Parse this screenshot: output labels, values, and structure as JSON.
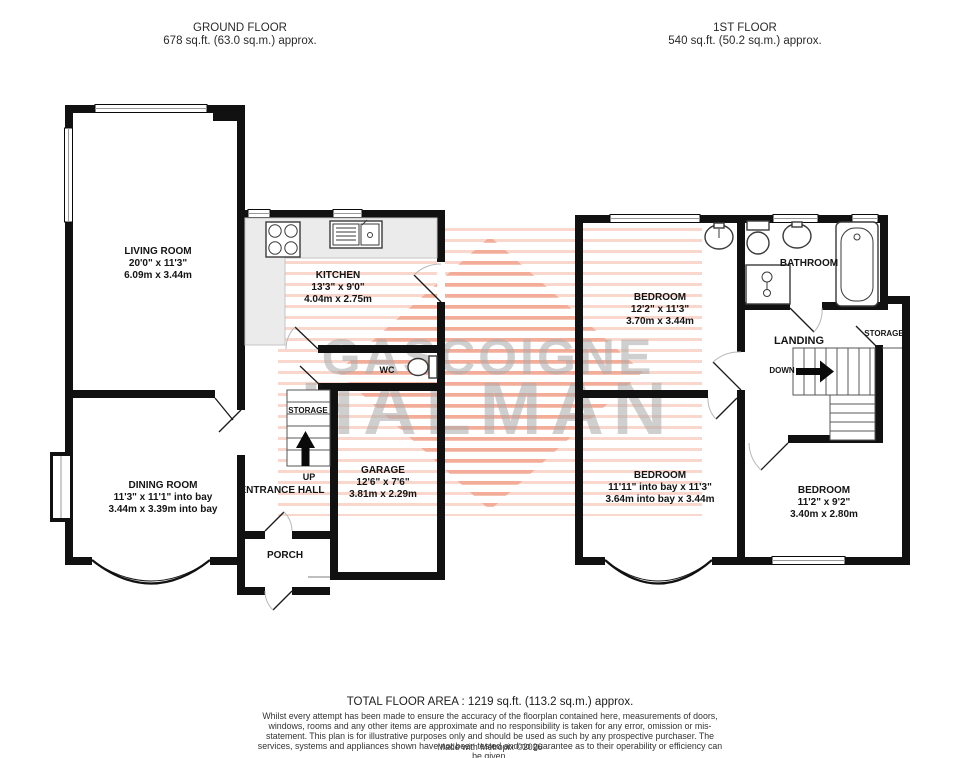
{
  "headers": {
    "ground": {
      "title": "GROUND FLOOR",
      "area": "678 sq.ft. (63.0 sq.m.) approx."
    },
    "first": {
      "title": "1ST FLOOR",
      "area": "540 sq.ft. (50.2 sq.m.) approx."
    }
  },
  "ground_floor": {
    "living_room": {
      "name": "LIVING ROOM",
      "imperial": "20'0\" x 11'3\"",
      "metric": "6.09m x 3.44m"
    },
    "kitchen": {
      "name": "KITCHEN",
      "imperial": "13'3\" x 9'0\"",
      "metric": "4.04m x 2.75m"
    },
    "dining_room": {
      "name": "DINING ROOM",
      "imperial": "11'3\" x 11'1\" into bay",
      "metric": "3.44m x 3.39m into bay"
    },
    "garage": {
      "name": "GARAGE",
      "imperial": "12'6\" x 7'6\"",
      "metric": "3.81m x 2.29m"
    },
    "wc_label": "WC",
    "storage_label": "STORAGE",
    "up_label": "UP",
    "entrance_hall_label": "ENTRANCE HALL",
    "porch_label": "PORCH"
  },
  "first_floor": {
    "bedroom_front": {
      "name": "BEDROOM",
      "imperial": "12'2\" x 11'3\"",
      "metric": "3.70m x 3.44m"
    },
    "bedroom_bay": {
      "name": "BEDROOM",
      "imperial": "11'11\" into bay x 11'3\"",
      "metric": "3.64m into bay x 3.44m"
    },
    "bedroom_rear": {
      "name": "BEDROOM",
      "imperial": "11'2\" x 9'2\"",
      "metric": "3.40m x 2.80m"
    },
    "bathroom_label": "BATHROOM",
    "landing_label": "LANDING",
    "down_label": "DOWN",
    "storage_label": "STORAGE"
  },
  "watermark": {
    "line1": "GASCOIGNE",
    "line2": "HALMAN",
    "stripe_light": "#f7d3c6",
    "stripe_dark": "#f0a98f",
    "text_color": "#acacac"
  },
  "footer": {
    "total": "TOTAL FLOOR AREA : 1219 sq.ft. (113.2 sq.m.) approx.",
    "disclaimer": "Whilst every attempt has been made to ensure the accuracy of the floorplan contained here, measurements of doors, windows, rooms and any other items are approximate and no responsibility is taken for any error, omission or mis-statement. This plan is for illustrative purposes only and should be used as such by any prospective purchaser. The services, systems and appliances shown have not been tested and no guarantee as to their operability or efficiency can be given.",
    "credit": "Made with Metropix ©2026"
  }
}
